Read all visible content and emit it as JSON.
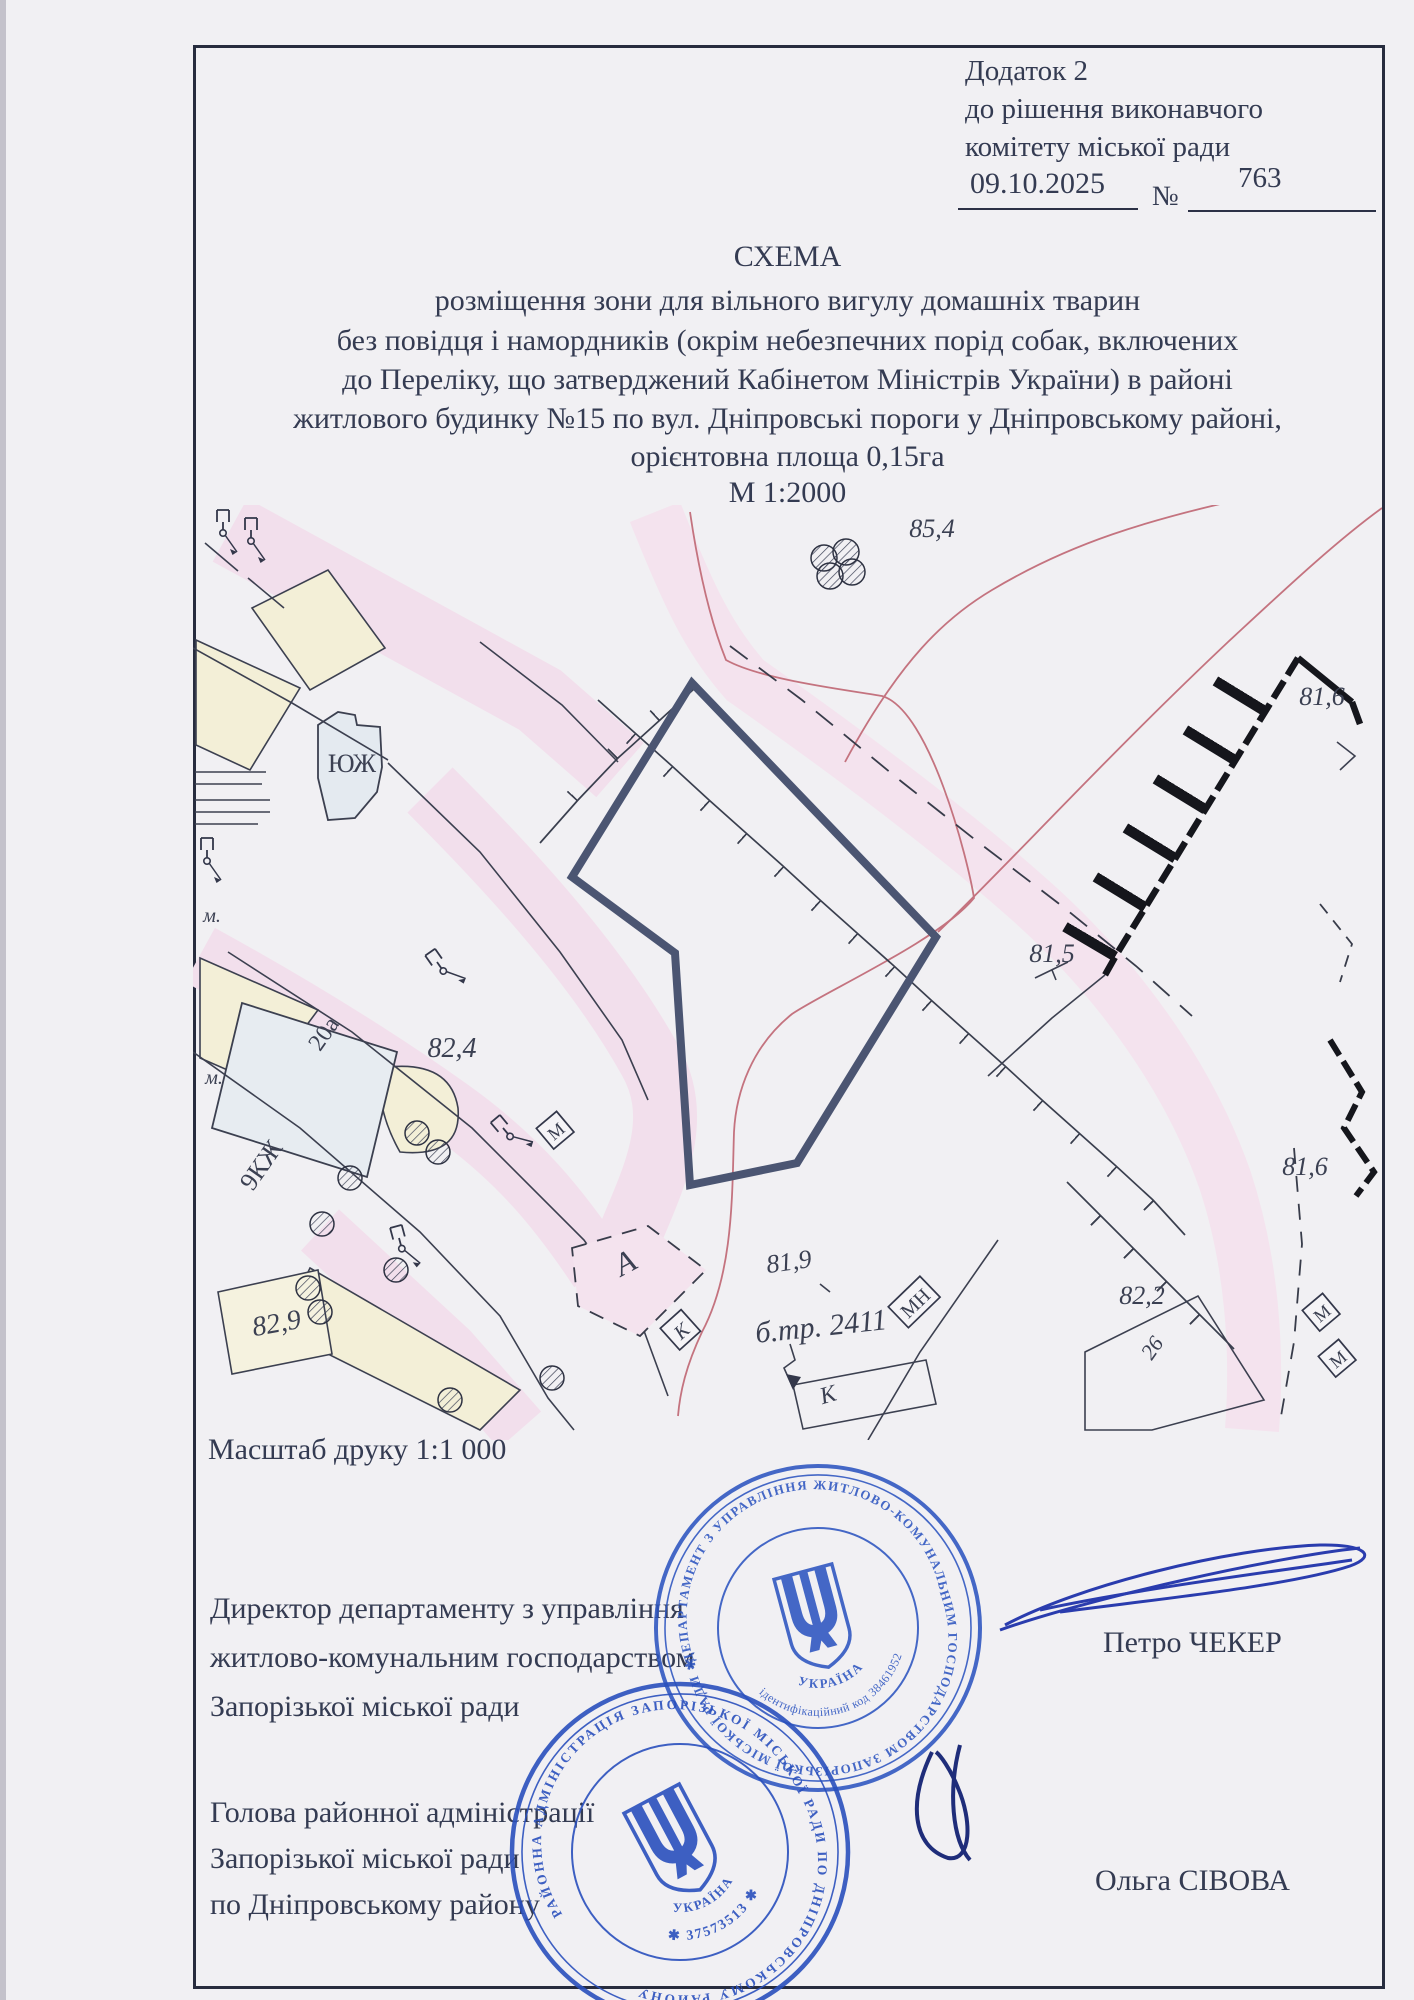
{
  "header": {
    "line1": "Додаток 2",
    "line2": "до рішення виконавчого",
    "line3": "комітету міської ради",
    "date": "09.10.2025",
    "number_sign": "№",
    "number": "763"
  },
  "title": {
    "line1": "СХЕМА",
    "line2": "розміщення зони для вільного вигулу домашніх тварин",
    "line3": "без повідця і намордників (окрім  небезпечних порід собак, включених",
    "line4": "до Переліку, що затверджений  Кабінетом Міністрів України)  в районі",
    "line5": "житлового будинку №15 по вул. Дніпровські пороги у Дніпровському районі,",
    "line6": "орієнтовна площа 0,15га",
    "line7": "М 1:2000"
  },
  "print_scale": "Масштаб друку  1:1 000",
  "signatories": [
    {
      "position_line1": "Директор департаменту з управління",
      "position_line2": "житлово-комунальним господарством",
      "position_line3": "Запорізької міської ради",
      "name": "Петро ЧЕКЕР"
    },
    {
      "position_line1": "Голова районної адміністрації",
      "position_line2": "Запорізької міської ради",
      "position_line3": "по Дніпровському району",
      "name": "Ольга СІВОВА"
    }
  ],
  "stamps": [
    {
      "ring_text": "ДЕПАРТАМЕНТ З УПРАВЛІННЯ ЖИТЛОВО-КОМУНАЛЬНИМ ГОСПОДАРСТВОМ ЗАПОРІЗЬКОЇ МІСЬКОЇ РАДИ ✱",
      "code_text": "ідентифікаційний код 38461952",
      "country": "УКРАЇНА"
    },
    {
      "ring_text": "РАЙОННА АДМІНІСТРАЦІЯ ЗАПОРІЗЬКОЇ МІСЬКОЇ РАДИ ПО ДНІПРОВСЬКОМУ РАЙОНУ",
      "code_text": "✱ 37573513 ✱",
      "country": "УКРАЇНА"
    }
  ],
  "map": {
    "labels": [
      {
        "text": "85,4",
        "x": 932,
        "y": 537,
        "r": 0,
        "s": 26,
        "i": true
      },
      {
        "text": "81,6",
        "x": 1322,
        "y": 705,
        "r": 0,
        "s": 26,
        "i": true
      },
      {
        "text": "81,5",
        "x": 1052,
        "y": 962,
        "r": 0,
        "s": 26,
        "i": true
      },
      {
        "text": "82,4",
        "x": 452,
        "y": 1057,
        "r": 0,
        "s": 28,
        "i": true
      },
      {
        "text": "20а",
        "x": 330,
        "y": 1038,
        "r": -55,
        "s": 24,
        "i": false
      },
      {
        "text": "9КЖ",
        "x": 268,
        "y": 1170,
        "r": -55,
        "s": 26,
        "i": false
      },
      {
        "text": "ЮЖ",
        "x": 352,
        "y": 772,
        "r": 0,
        "s": 26,
        "i": false
      },
      {
        "text": "82,9",
        "x": 278,
        "y": 1332,
        "r": -10,
        "s": 28,
        "i": true
      },
      {
        "text": "А",
        "x": 630,
        "y": 1272,
        "r": -28,
        "s": 32,
        "i": true
      },
      {
        "text": "К",
        "x": 686,
        "y": 1336,
        "r": -42,
        "s": 20,
        "i": true,
        "b": true
      },
      {
        "text": "81,9",
        "x": 790,
        "y": 1270,
        "r": -8,
        "s": 26,
        "i": true
      },
      {
        "text": "б.тр. 2411",
        "x": 822,
        "y": 1336,
        "r": -6,
        "s": 30,
        "i": true
      },
      {
        "text": "МН",
        "x": 920,
        "y": 1308,
        "r": -44,
        "s": 20,
        "i": false,
        "b": true
      },
      {
        "text": "К",
        "x": 830,
        "y": 1402,
        "r": -16,
        "s": 24,
        "i": true
      },
      {
        "text": "82,2",
        "x": 1142,
        "y": 1304,
        "r": 0,
        "s": 26,
        "i": true
      },
      {
        "text": "26",
        "x": 1158,
        "y": 1352,
        "r": -55,
        "s": 22,
        "i": true
      },
      {
        "text": "81,6",
        "x": 1305,
        "y": 1175,
        "r": 0,
        "s": 26,
        "i": true
      },
      {
        "text": "М",
        "x": 560,
        "y": 1136,
        "r": -40,
        "s": 18,
        "i": false,
        "b": true
      },
      {
        "text": "М",
        "x": 1326,
        "y": 1318,
        "r": -40,
        "s": 18,
        "i": false,
        "b": true
      },
      {
        "text": "М",
        "x": 1342,
        "y": 1364,
        "r": -40,
        "s": 18,
        "i": false,
        "b": true
      },
      {
        "text": "м.",
        "x": 212,
        "y": 922,
        "r": 0,
        "s": 20,
        "i": true
      },
      {
        "text": "м.",
        "x": 214,
        "y": 1084,
        "r": 0,
        "s": 20,
        "i": true
      }
    ]
  }
}
